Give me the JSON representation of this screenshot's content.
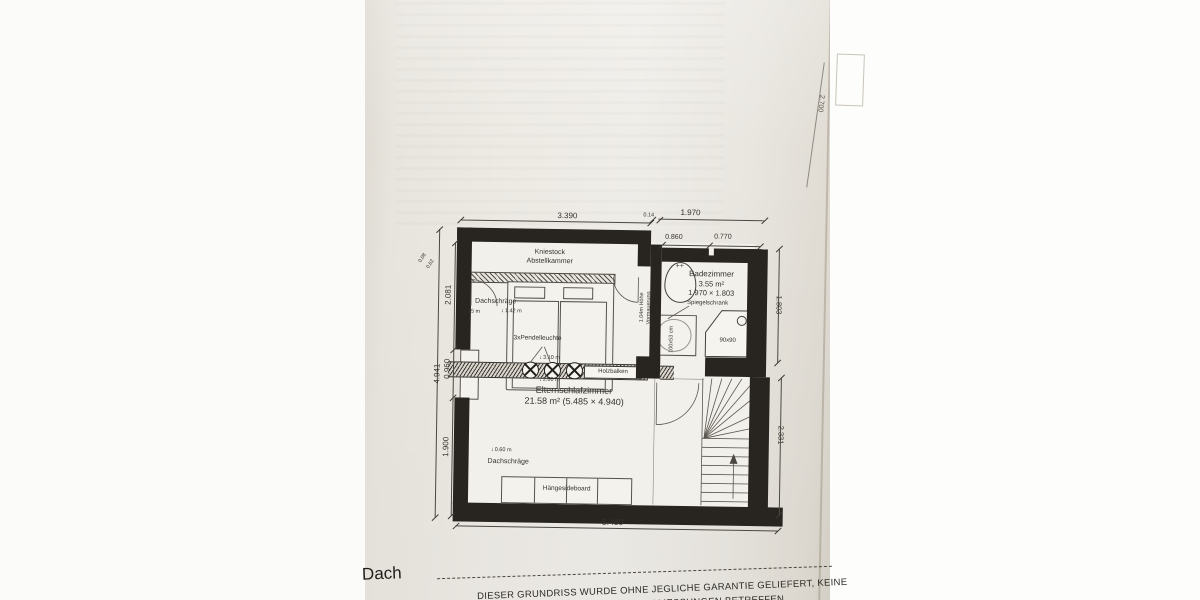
{
  "plan": {
    "rooms": {
      "abstellkammer": {
        "line1": "Kniestock",
        "line2": "Abstellkammer"
      },
      "bedroom": {
        "name": "Elternschlafzimmer",
        "area": "21.58 m² (5.485 × 4.940)"
      },
      "bathroom": {
        "name": "Badezimmer",
        "area": "3.55 m²",
        "size": "1.970 × 1.803"
      }
    },
    "annotations": {
      "dachschraege_top": "Dachschräge",
      "dachschraege_top_h1": "25 m",
      "dachschraege_top_h2": "1.42 m",
      "pendant": "3xPendelleuchte",
      "pendant_h1": "3.10 m",
      "pendant_h2": "2.60 m",
      "holzbalken": "Holzbalken",
      "dachschraege_bottom": "Dachschräge",
      "dachschraege_bottom_h": "0.60 m",
      "sideboard": "Hängesideboard",
      "spiegelschrank": "Spiegelschrank",
      "vormauerung_line1": "1.04m Höhe",
      "vormauerung_line2": "Vormauerung",
      "sink_size": "100x53 cm",
      "shower_size": "90x90"
    },
    "dimensions": {
      "top_main": "3.390",
      "top_gap": "0.14",
      "top_bath": "1.970",
      "bath_left": "0.860",
      "bath_right": "0.770",
      "left_total": "4.941",
      "left_upper": "2.081",
      "left_window": "0.960",
      "left_lower": "1.900",
      "left_small1": "0.08",
      "left_small2": "0.62",
      "right_bath": "1.803",
      "right_stair": "2.331",
      "right_edge_clipped": "2.700",
      "bottom": "5.480"
    }
  },
  "footer": {
    "label": "Dach",
    "disclaimer_line1": "DIESER GRUNDRISS WURDE OHNE JEGLICHE GARANTIE GELIEFERT, KEINE",
    "disclaimer_line2": "DIE PRÄZISION DER ABMESSUNGEN BETREFFEN"
  }
}
